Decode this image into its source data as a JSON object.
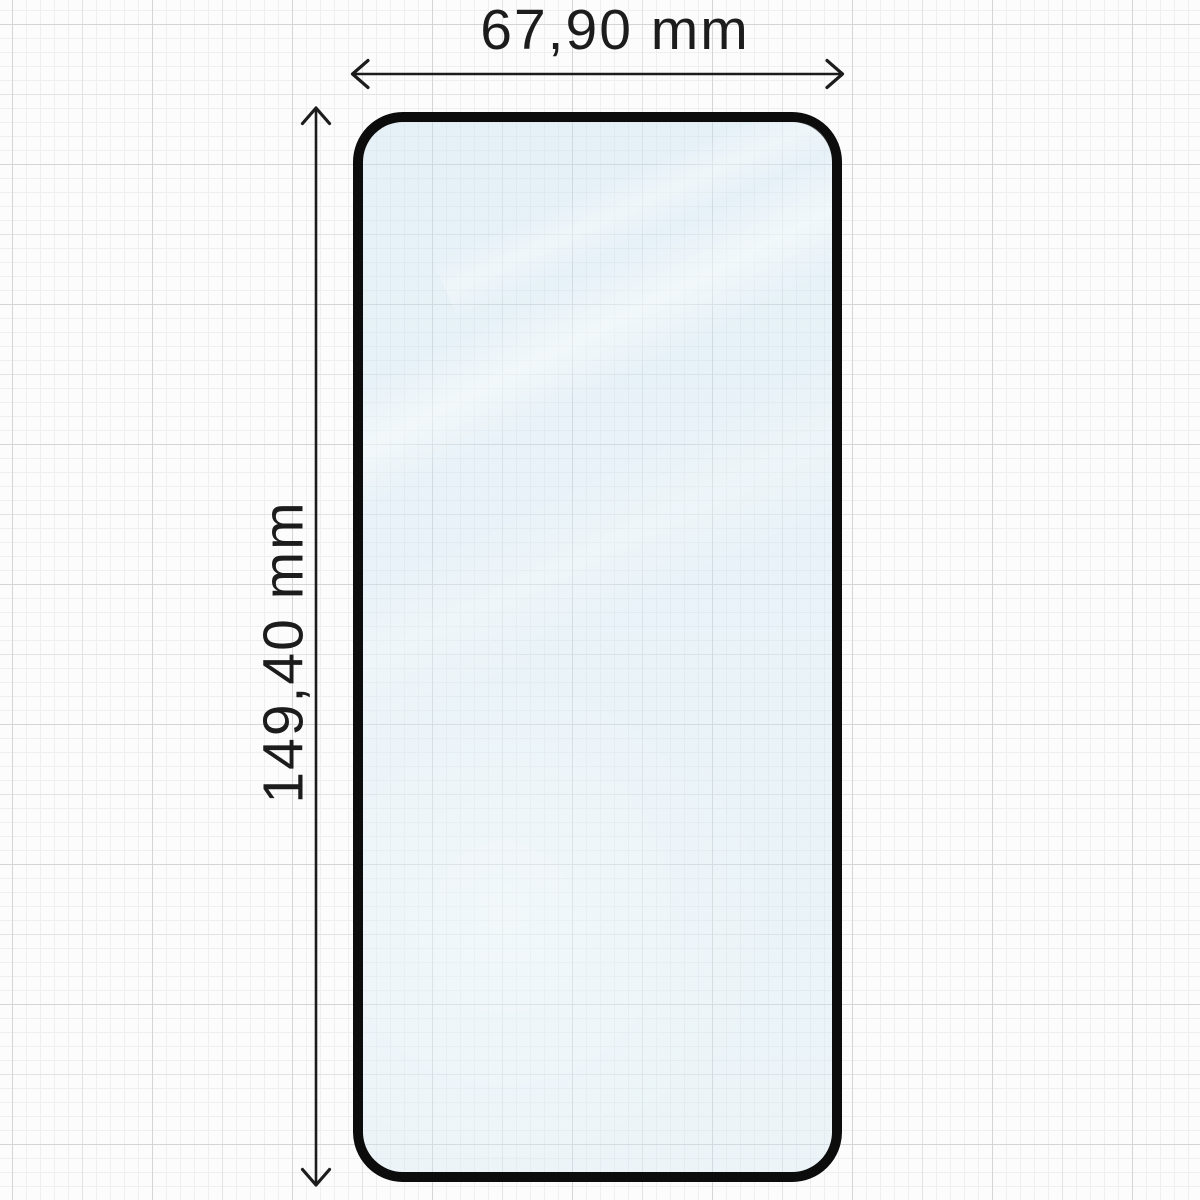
{
  "diagram": {
    "type": "product-dimension-diagram",
    "subject": "tempered glass screen protector on graph paper",
    "width_dimension": {
      "label": "67,90 mm",
      "value": "67,90",
      "unit": "mm",
      "orientation": "horizontal"
    },
    "height_dimension": {
      "label": "149,40 mm",
      "value": "149,40",
      "unit": "mm",
      "orientation": "vertical"
    }
  },
  "colors": {
    "page_background": "#fcfcfc",
    "grid_minor_line": "#efefef",
    "grid_mid_line": "#e3e3e3",
    "grid_major_line": "#d5d5d5",
    "glass_border": "#0c0c0c",
    "glass_tint": "#e9f2f7",
    "glass_reflection": "#ffffff",
    "dimension_line": "#1c1c1c",
    "label_text": "#1c1c1c"
  }
}
